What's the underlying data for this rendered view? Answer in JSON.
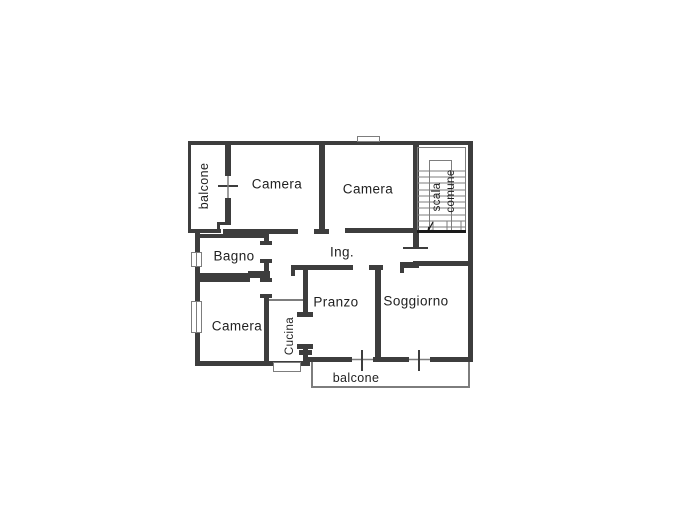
{
  "floorplan": {
    "title": "apartment-floor-plan",
    "colors": {
      "wall": "#3d3d3d",
      "thin_line": "#7d7d7d",
      "dark_line": "#1a1a1a",
      "text": "#1f1f1f",
      "background": "#ffffff"
    },
    "stair_arrow_glyph": "↓",
    "rooms": [
      {
        "id": "balcone-left",
        "label": "balcone",
        "orientation": "vertical"
      },
      {
        "id": "camera-1",
        "label": "Camera",
        "orientation": "horizontal"
      },
      {
        "id": "camera-2",
        "label": "Camera",
        "orientation": "horizontal"
      },
      {
        "id": "scala",
        "label": "scala",
        "orientation": "vertical"
      },
      {
        "id": "comune",
        "label": "comune",
        "orientation": "vertical"
      },
      {
        "id": "bagno",
        "label": "Bagno",
        "orientation": "horizontal"
      },
      {
        "id": "ingresso",
        "label": "Ing.",
        "orientation": "horizontal"
      },
      {
        "id": "camera-3",
        "label": "Camera",
        "orientation": "horizontal"
      },
      {
        "id": "cucina",
        "label": "Cucina",
        "orientation": "vertical"
      },
      {
        "id": "pranzo",
        "label": "Pranzo",
        "orientation": "horizontal"
      },
      {
        "id": "soggiorno",
        "label": "Soggiorno",
        "orientation": "horizontal"
      },
      {
        "id": "balcone-bottom",
        "label": "balcone",
        "orientation": "horizontal"
      }
    ]
  }
}
